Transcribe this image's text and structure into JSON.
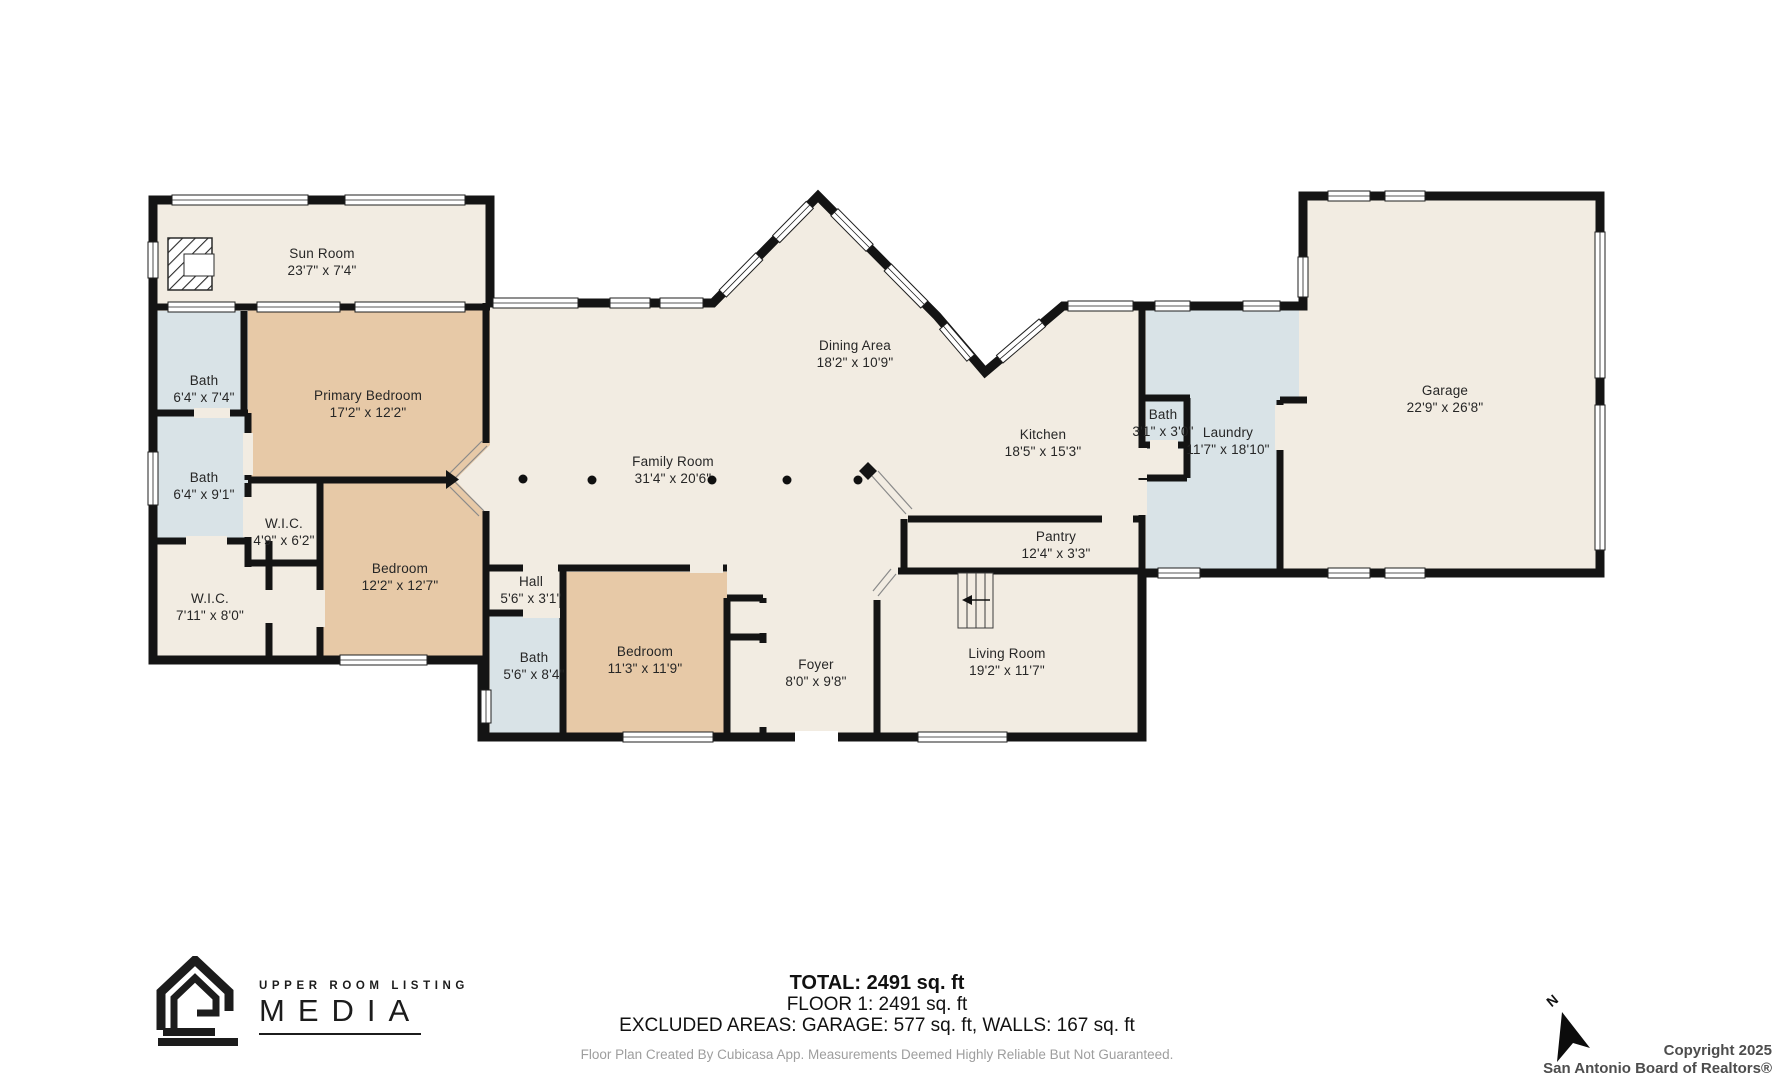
{
  "rooms": {
    "sun_room": {
      "name": "Sun Room",
      "dims": "23'7\" x 7'4\""
    },
    "bath_1": {
      "name": "Bath",
      "dims": "6'4\" x 7'4\""
    },
    "primary_bedroom": {
      "name": "Primary Bedroom",
      "dims": "17'2\" x 12'2\""
    },
    "bath_2": {
      "name": "Bath",
      "dims": "6'4\" x 9'1\""
    },
    "wic_1": {
      "name": "W.I.C.",
      "dims": "4'9\" x 6'2\""
    },
    "wic_2": {
      "name": "W.I.C.",
      "dims": "7'11\" x 8'0\""
    },
    "bedroom_1": {
      "name": "Bedroom",
      "dims": "12'2\" x 12'7\""
    },
    "hall": {
      "name": "Hall",
      "dims": "5'6\" x 3'1\""
    },
    "bath_3": {
      "name": "Bath",
      "dims": "5'6\" x 8'4\""
    },
    "bedroom_2": {
      "name": "Bedroom",
      "dims": "11'3\" x 11'9\""
    },
    "family_room": {
      "name": "Family Room",
      "dims": "31'4\" x 20'6\""
    },
    "dining_area": {
      "name": "Dining Area",
      "dims": "18'2\" x 10'9\""
    },
    "kitchen": {
      "name": "Kitchen",
      "dims": "18'5\" x 15'3\""
    },
    "pantry": {
      "name": "Pantry",
      "dims": "12'4\" x 3'3\""
    },
    "foyer": {
      "name": "Foyer",
      "dims": "8'0\" x 9'8\""
    },
    "living_room": {
      "name": "Living Room",
      "dims": "19'2\" x 11'7\""
    },
    "bath_4": {
      "name": "Bath",
      "dims": "3'1\" x 3'0\""
    },
    "laundry": {
      "name": "Laundry",
      "dims": "11'7\" x 18'10\""
    },
    "garage": {
      "name": "Garage",
      "dims": "22'9\" x 26'8\""
    }
  },
  "footer": {
    "total": "TOTAL: 2491 sq. ft",
    "floor": "FLOOR 1: 2491 sq. ft",
    "excluded": "EXCLUDED AREAS: GARAGE: 577 sq. ft, WALLS: 167 sq. ft",
    "disclaimer": "Floor Plan Created By Cubicasa App. Measurements Deemed Highly Reliable But Not Guaranteed."
  },
  "branding": {
    "line1": "UPPER ROOM LISTING",
    "line2": "MEDIA"
  },
  "compass": {
    "label": "N"
  },
  "copyright": {
    "line1": "Copyright 2025",
    "line2": "San Antonio Board of Realtors®"
  },
  "colors": {
    "floor": "#f2ece2",
    "bedroom": "#e7c9a7",
    "wet": "#d9e3e7",
    "wall": "#141414"
  }
}
